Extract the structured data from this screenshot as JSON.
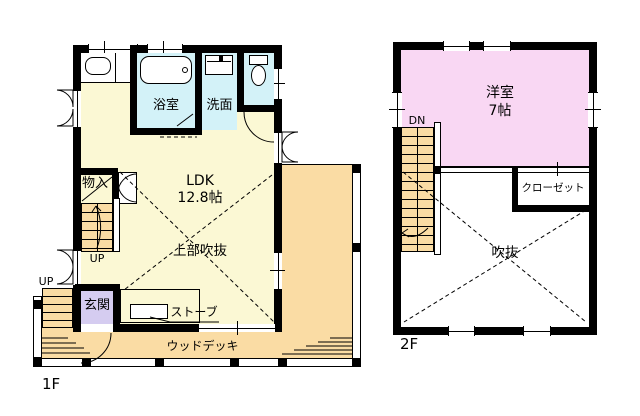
{
  "colors": {
    "wall": "#000000",
    "ldk_fill": "#FBF8D4",
    "deck_fill": "#FADCA4",
    "wet_area_fill": "#D3F2F8",
    "entrance_fill": "#D5CCF0",
    "western_room_fill": "#F9D7F3",
    "background": "#FFFFFF"
  },
  "floor1": {
    "floor_label": "1F",
    "bath": "浴室",
    "washroom": "洗面",
    "ldk_name": "LDK",
    "ldk_size": "12.8帖",
    "upper_void": "上部吹抜",
    "storage": "物入",
    "stairs_up": "UP",
    "porch_up": "UP",
    "entrance": "玄関",
    "stove": "ストーブ",
    "wood_deck": "ウッドデッキ"
  },
  "floor2": {
    "floor_label": "2F",
    "western_room_name": "洋室",
    "western_room_size": "7帖",
    "stairs_down": "DN",
    "closet": "クローゼット",
    "void": "吹抜"
  }
}
